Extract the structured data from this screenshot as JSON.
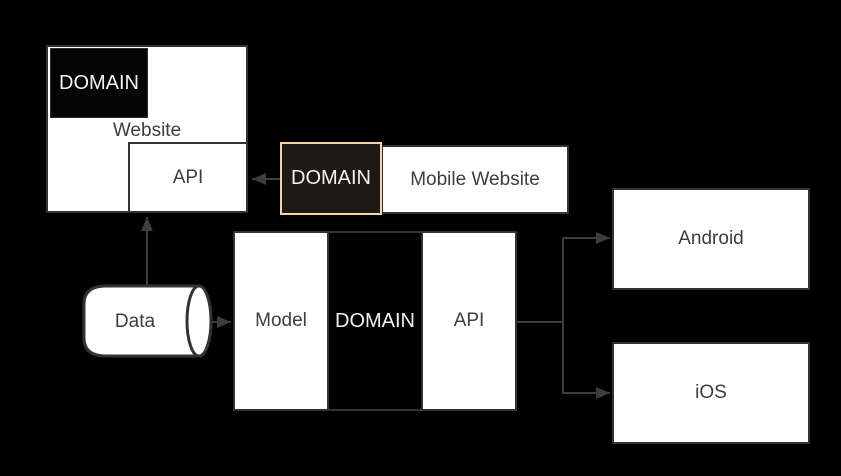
{
  "diagram": {
    "colors": {
      "background": "#000000",
      "node_fill": "#ffffff",
      "node_border": "#333333",
      "dark_fill": "#000000",
      "dark_text": "#f2f2f2",
      "label_text": "#3d3d3d",
      "highlight_border": "#f6d2ad",
      "connector": "#3d3d3d"
    },
    "nodes": {
      "website": {
        "label": "Website"
      },
      "website_domain": {
        "label": "DOMAIN"
      },
      "website_api": {
        "label": "API"
      },
      "mobile_domain": {
        "label": "DOMAIN"
      },
      "mobile_website": {
        "label": "Mobile Website"
      },
      "model": {
        "label": "Model"
      },
      "backend_domain": {
        "label": "DOMAIN"
      },
      "backend_api": {
        "label": "API"
      },
      "android": {
        "label": "Android"
      },
      "ios": {
        "label": "iOS"
      },
      "data_store": {
        "label": "Data"
      }
    },
    "edges": [
      {
        "from": "mobile_domain",
        "to": "website_api"
      },
      {
        "from": "data_store",
        "to": "website_api"
      },
      {
        "from": "data_store",
        "to": "model"
      },
      {
        "from": "backend_api",
        "to": "android"
      },
      {
        "from": "backend_api",
        "to": "ios"
      }
    ]
  }
}
